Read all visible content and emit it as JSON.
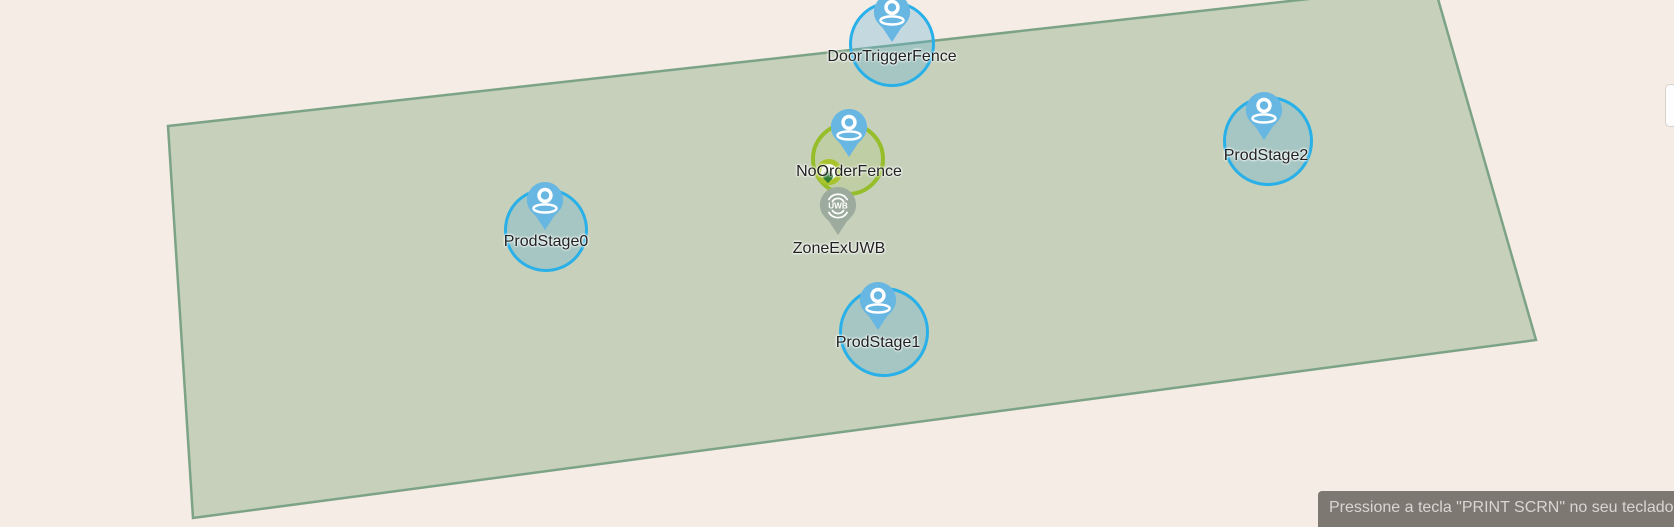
{
  "app": {
    "view": "geofence-map-canvas"
  },
  "colors": {
    "map_background": "#f5ece5",
    "zone_polygon_fill": "#c6d1bc",
    "zone_polygon_border": "#7da387",
    "blue_fence_border": "#29b0e8",
    "green_fence_border": "#96be2a",
    "mini_circle_ring": "#a9c32c",
    "blue_pin": "#68b6e2",
    "uwb_pin": "#9cab9d",
    "tooltip_background": "#6c6862",
    "tooltip_text_color": "#d9d6d1"
  },
  "markers": [
    {
      "label": "DoorTriggerFence",
      "kind": "geofence-blue"
    },
    {
      "label": "NoOrderFence",
      "kind": "geofence-green"
    },
    {
      "label": "ZoneExUWB",
      "kind": "uwb-zone",
      "pin_text": "UWB"
    },
    {
      "label": "ProdStage0",
      "kind": "geofence-blue"
    },
    {
      "label": "ProdStage1",
      "kind": "geofence-blue"
    },
    {
      "label": "ProdStage2",
      "kind": "geofence-blue"
    }
  ],
  "tooltip": {
    "text": "Pressione a tecla \"PRINT SCRN\" no seu teclado para"
  }
}
